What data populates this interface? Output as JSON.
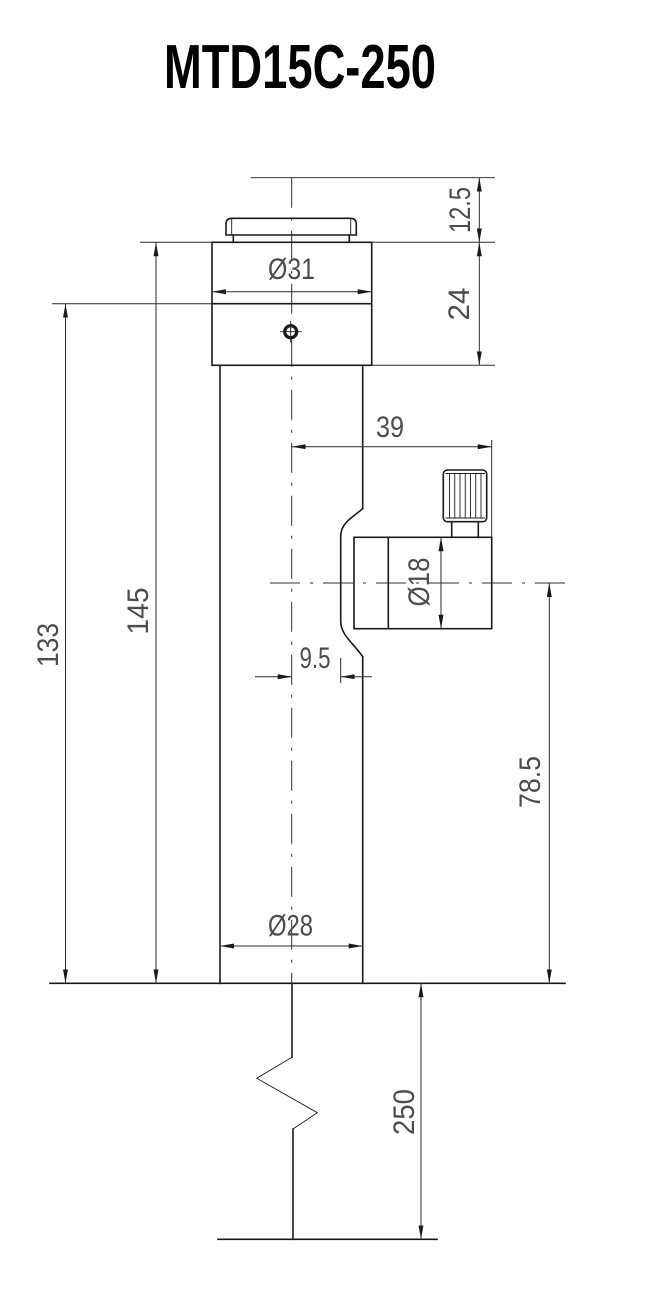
{
  "title": "MTD15C-250",
  "colors": {
    "background": "#ffffff",
    "line": "#1a1a1a",
    "dimension_text": "#4d4d4d"
  },
  "dimensions": {
    "top_extension_height": "12.5",
    "head_height": "24",
    "head_diameter": "Ø31",
    "port_reach": "39",
    "port_diameter": "Ø18",
    "saddle_offset": "9.5",
    "shoulder_to_base": "133",
    "head_top_to_base": "145",
    "port_axis_to_base": "78.5",
    "tube_diameter": "Ø28",
    "stem_length": "250"
  }
}
